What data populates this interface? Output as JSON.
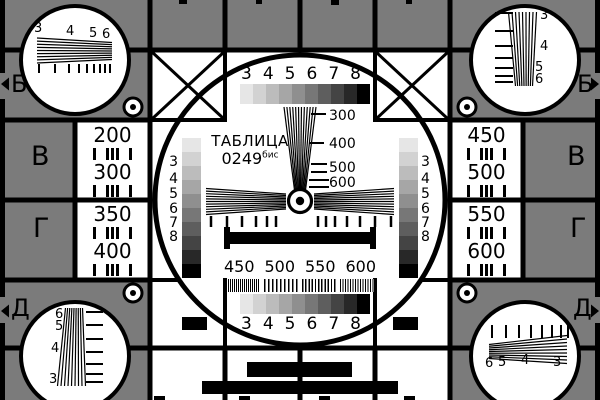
{
  "colors": {
    "background": "#7b7b7b",
    "ink": "#000000",
    "panel": "#ffffff",
    "grayscale_steps": [
      "#e6e6e6",
      "#d2d2d2",
      "#bcbcbc",
      "#a6a6a6",
      "#8f8f8f",
      "#777777",
      "#5e5e5e",
      "#444444",
      "#282828",
      "#000000"
    ]
  },
  "title": {
    "text": "ТАБЛИЦА",
    "code": "0249",
    "code_sup": "бис"
  },
  "row_labels": {
    "left_b": "Б",
    "left_v": "В",
    "left_g": "Г",
    "left_d": "Д",
    "right_b": "Б",
    "right_v": "В",
    "right_g": "Г",
    "right_d": "Д"
  },
  "center": {
    "top_scale": [
      "3",
      "4",
      "5",
      "6",
      "7",
      "8"
    ],
    "bottom_scale": [
      "3",
      "4",
      "5",
      "6",
      "7",
      "8"
    ],
    "left_strip_scale": [
      "3",
      "4",
      "5",
      "6",
      "7",
      "8"
    ],
    "right_strip_scale": [
      "3",
      "4",
      "5",
      "6",
      "7",
      "8"
    ],
    "wedge_labels": [
      "300",
      "400",
      "500",
      "600"
    ],
    "burst_labels": [
      "450",
      "500",
      "550",
      "600"
    ]
  },
  "panels": {
    "left_top": [
      "200",
      "300"
    ],
    "left_bottom": [
      "350",
      "400"
    ],
    "right_top": [
      "450",
      "500"
    ],
    "right_bottom": [
      "550",
      "600"
    ]
  },
  "corner_wedges": {
    "top_left": [
      "3",
      "4",
      "5",
      "6"
    ],
    "top_right": [
      "3",
      "4",
      "5",
      "6"
    ],
    "bottom_left": [
      "6",
      "5",
      "4",
      "3"
    ],
    "bottom_right": [
      "6",
      "5",
      "4",
      "3"
    ]
  }
}
